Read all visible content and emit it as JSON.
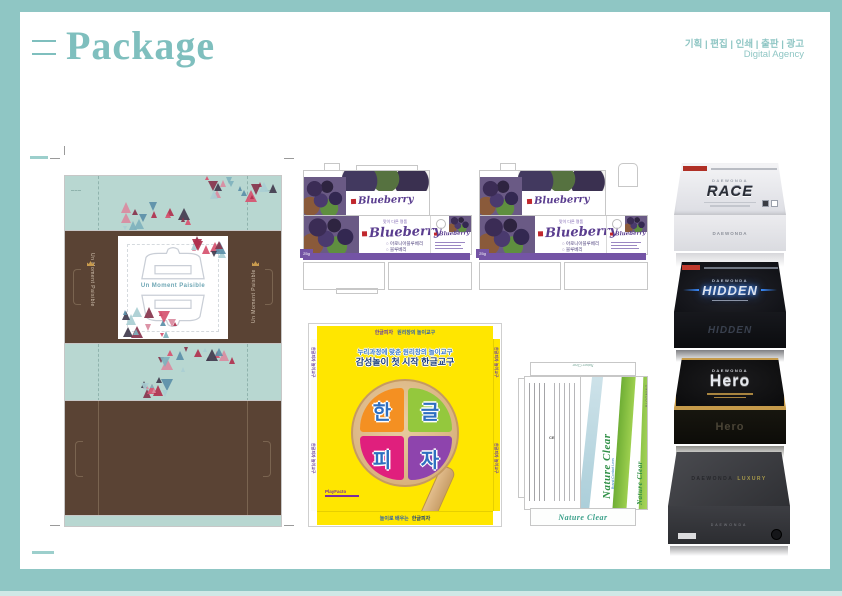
{
  "colors": {
    "frame": "#8fc6c4",
    "title": "#7fbfbe",
    "mint": "#b8d7d1",
    "brown": "#5a4334",
    "stripe_purple": "#7454a5",
    "pizza_yellow": "#ffe600",
    "nature_green": "#6fae35",
    "nature_blue": "#b7d4de",
    "glow_blue": "#3a8cff",
    "gold": "#c59a4a"
  },
  "header": {
    "title": "Package",
    "services": "기획 | 편집 | 인쇄 | 출판 | 광고",
    "agency": "Digital Agency"
  },
  "furniture": {
    "brand_text": "Un Moment Paisible",
    "panel_text": "Un Moment Paisible",
    "triangle_palette": [
      "#d6536f",
      "#87344c",
      "#a9ced2",
      "#423c4e",
      "#d98ba0",
      "#7fb2bd",
      "#5b8fa8",
      "#b0314e"
    ]
  },
  "blueberry": {
    "tagline": "맛이 다른 명품",
    "logo": "Blueberry",
    "items": [
      "아로니아블루베리",
      "블루베리"
    ],
    "weight": "25g"
  },
  "pizza": {
    "flap_title": "한글피자",
    "flap_subtitle": "원리창의 놀이교구",
    "line1": "누리과정에 맞춘 원리창의 놀이교구",
    "line2": "감성놀이 첫 시작 한글교구",
    "slices": [
      "한",
      "글",
      "피",
      "자"
    ],
    "side_text": "한글피자 놀이교구",
    "logo": "PlayFacto",
    "bottom_prefix": "놀이로 배우는",
    "bottom_title": "한글피자"
  },
  "nature": {
    "title": "Nature Clear",
    "subtitle": "Brand Contact Lens",
    "brand": "BLOOMING",
    "ce": "CE",
    "top_title": "Nature Clear",
    "side_title": "Nature Clear",
    "bottom_title": "Nature Clear"
  },
  "boxes": [
    {
      "brand": "DAEWONDA",
      "name": "RACE"
    },
    {
      "brand": "DAEWONDA",
      "name": "HIDDEN"
    },
    {
      "brand": "DAEWONDA",
      "name": "Hero"
    },
    {
      "brand": "DAEWONDA",
      "name": "LUXURY"
    }
  ]
}
